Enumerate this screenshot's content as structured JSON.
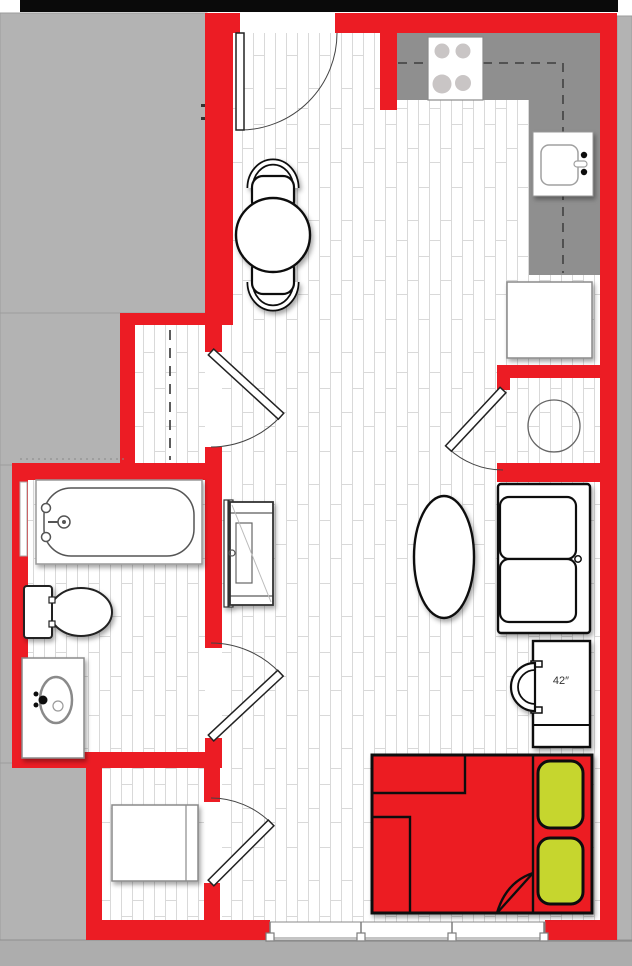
{
  "document": {
    "kind": "studio-apartment-floor-plan"
  },
  "labels": {
    "tv_size": "42″"
  },
  "colors": {
    "wall_red": "#ec1c24",
    "bed_red": "#ec1c24",
    "exterior_gray": "#b3b3b3",
    "exterior_band_gray": "#adadad",
    "counter_gray": "#8f8f8f",
    "burner_gray": "#c9c5c5",
    "pillow_green": "#c6d62f",
    "plank_line": "#d9d9d9",
    "outline_black": "#111111",
    "top_strip_black": "#0a0a0a",
    "fixture_line": "#555555"
  },
  "rooms": {
    "main_living": "open living / sleeping area",
    "kitchen": "kitchen with L-shaped counter",
    "bathroom": "bathroom",
    "entry_closet": "closet with hanging rod",
    "laundry_closet": "washer closet",
    "storage_room": "storage / utility room"
  },
  "fixtures": [
    "entry-door",
    "closet-door",
    "bathroom-door",
    "storage-door",
    "washer-closet-door",
    "range-4-burner",
    "kitchen-sink",
    "refrigerator",
    "upper-cabinet-dashed-line",
    "round-dining-table",
    "dining-chair",
    "dining-chair",
    "oval-coffee-table",
    "dresser",
    "loveseat-sofa",
    "tv-42-inch",
    "tv-console",
    "washer",
    "bathtub",
    "toilet",
    "vanity-sink",
    "bed-with-two-pillows",
    "window-band"
  ]
}
